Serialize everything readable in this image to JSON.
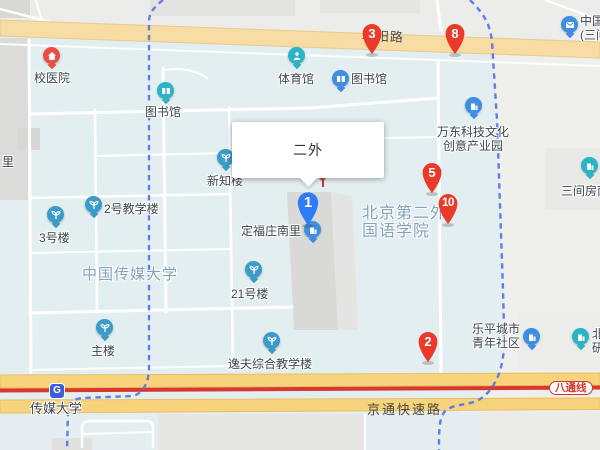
{
  "map": {
    "roads": {
      "chaoyang": "朝阳路",
      "jingtong": "京通快速路",
      "batong_badge": "八通线"
    },
    "subway": {
      "station": "传媒大学",
      "logo": "G"
    },
    "infowindow": {
      "title": "二外"
    },
    "markers": {
      "m1": "1",
      "m2": "2",
      "m3": "3",
      "m5": "5",
      "m8": "8",
      "m10": "10"
    },
    "pois": {
      "xiaoyiyuan": "校医院",
      "tushuguan_left": "图书馆",
      "tiyuguan": "体育馆",
      "tushuguan_right": "图书馆",
      "xinzhilou": "新知楼",
      "erhaojiaoxuelou": "2号教学楼",
      "sanhaolou": "3号楼",
      "ershiyihaolou": "21号楼",
      "zhulou": "主楼",
      "yifulou": "逸夫综合教学楼",
      "dingfuzhuangnanli": "定福庄南里"
    },
    "areas": {
      "cuc": "中国传媒大学",
      "bisu": [
        "北京第二外",
        "国语学院"
      ],
      "wandong": [
        "万东科技文化",
        "创意产业园"
      ],
      "leping": [
        "乐平城市",
        "青年社区"
      ],
      "sanjianfang": "三间房南",
      "postal": [
        "中国",
        "(三间"
      ],
      "partial_left": "里",
      "partial_right": [
        "北",
        "研"
      ]
    },
    "icons": {
      "subway": "subway-logo-icon",
      "hospital_pin": "home-icon",
      "library_pin": "book-icon",
      "gym_pin": "sports-icon",
      "campus_building_pin": "sprout-icon",
      "residential_pin": "building-icon",
      "post_pin": "envelope-icon",
      "numbered_marker": "teardrop-pin-icon",
      "location_needle": "needle-pin-icon"
    },
    "colors": {
      "marker_red": "#ea3b2a",
      "marker_blue": "#2e7cf6",
      "pin_blue": "#3e8ee2",
      "pin_teal": "#2bb4c5",
      "pin_campus": "#3b9cc9",
      "pin_red": "#ea4f44",
      "road_yellow_major": "#f7d47c",
      "road_yellow_pale": "#f7dca4",
      "subway_line_red": "#d8382e",
      "boundary_blue": "#5b76e8",
      "area_text": "#7ea3ba",
      "campus_bg": "#e3eef0"
    }
  }
}
